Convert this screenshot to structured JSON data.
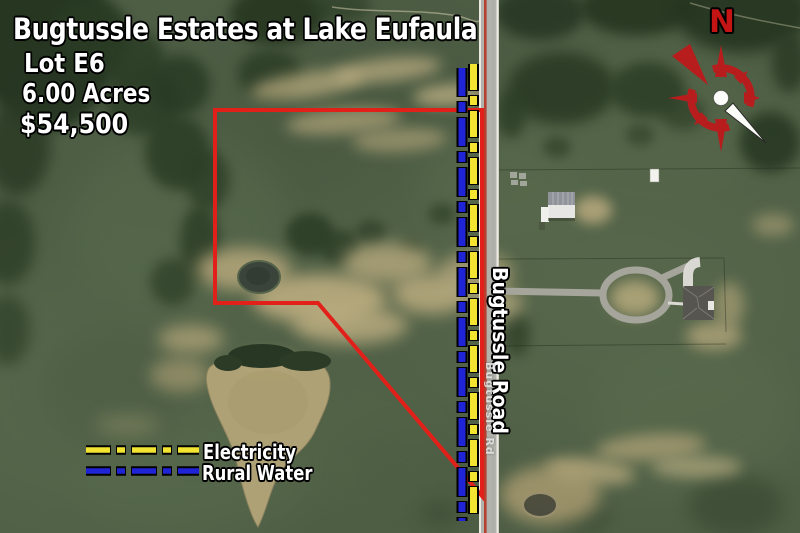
{
  "listing": {
    "title": "Bugtussle Estates at Lake Eufaula",
    "lot": "Lot E6",
    "acreage": "6.00 Acres",
    "price": "$54,500"
  },
  "legend": {
    "items": [
      {
        "label": "Electricity"
      },
      {
        "label": "Rural Water"
      }
    ]
  },
  "road": {
    "name": "Bugtussle Road",
    "map_label": "Bugtussle Rd"
  },
  "compass": {
    "north": "N"
  },
  "colors": {
    "boundary": "#e2201a",
    "electricity": "#f2e431",
    "rural_water": "#1f25d6",
    "road_centerline": "#b5402f",
    "compass_red": "#b81d1d"
  }
}
